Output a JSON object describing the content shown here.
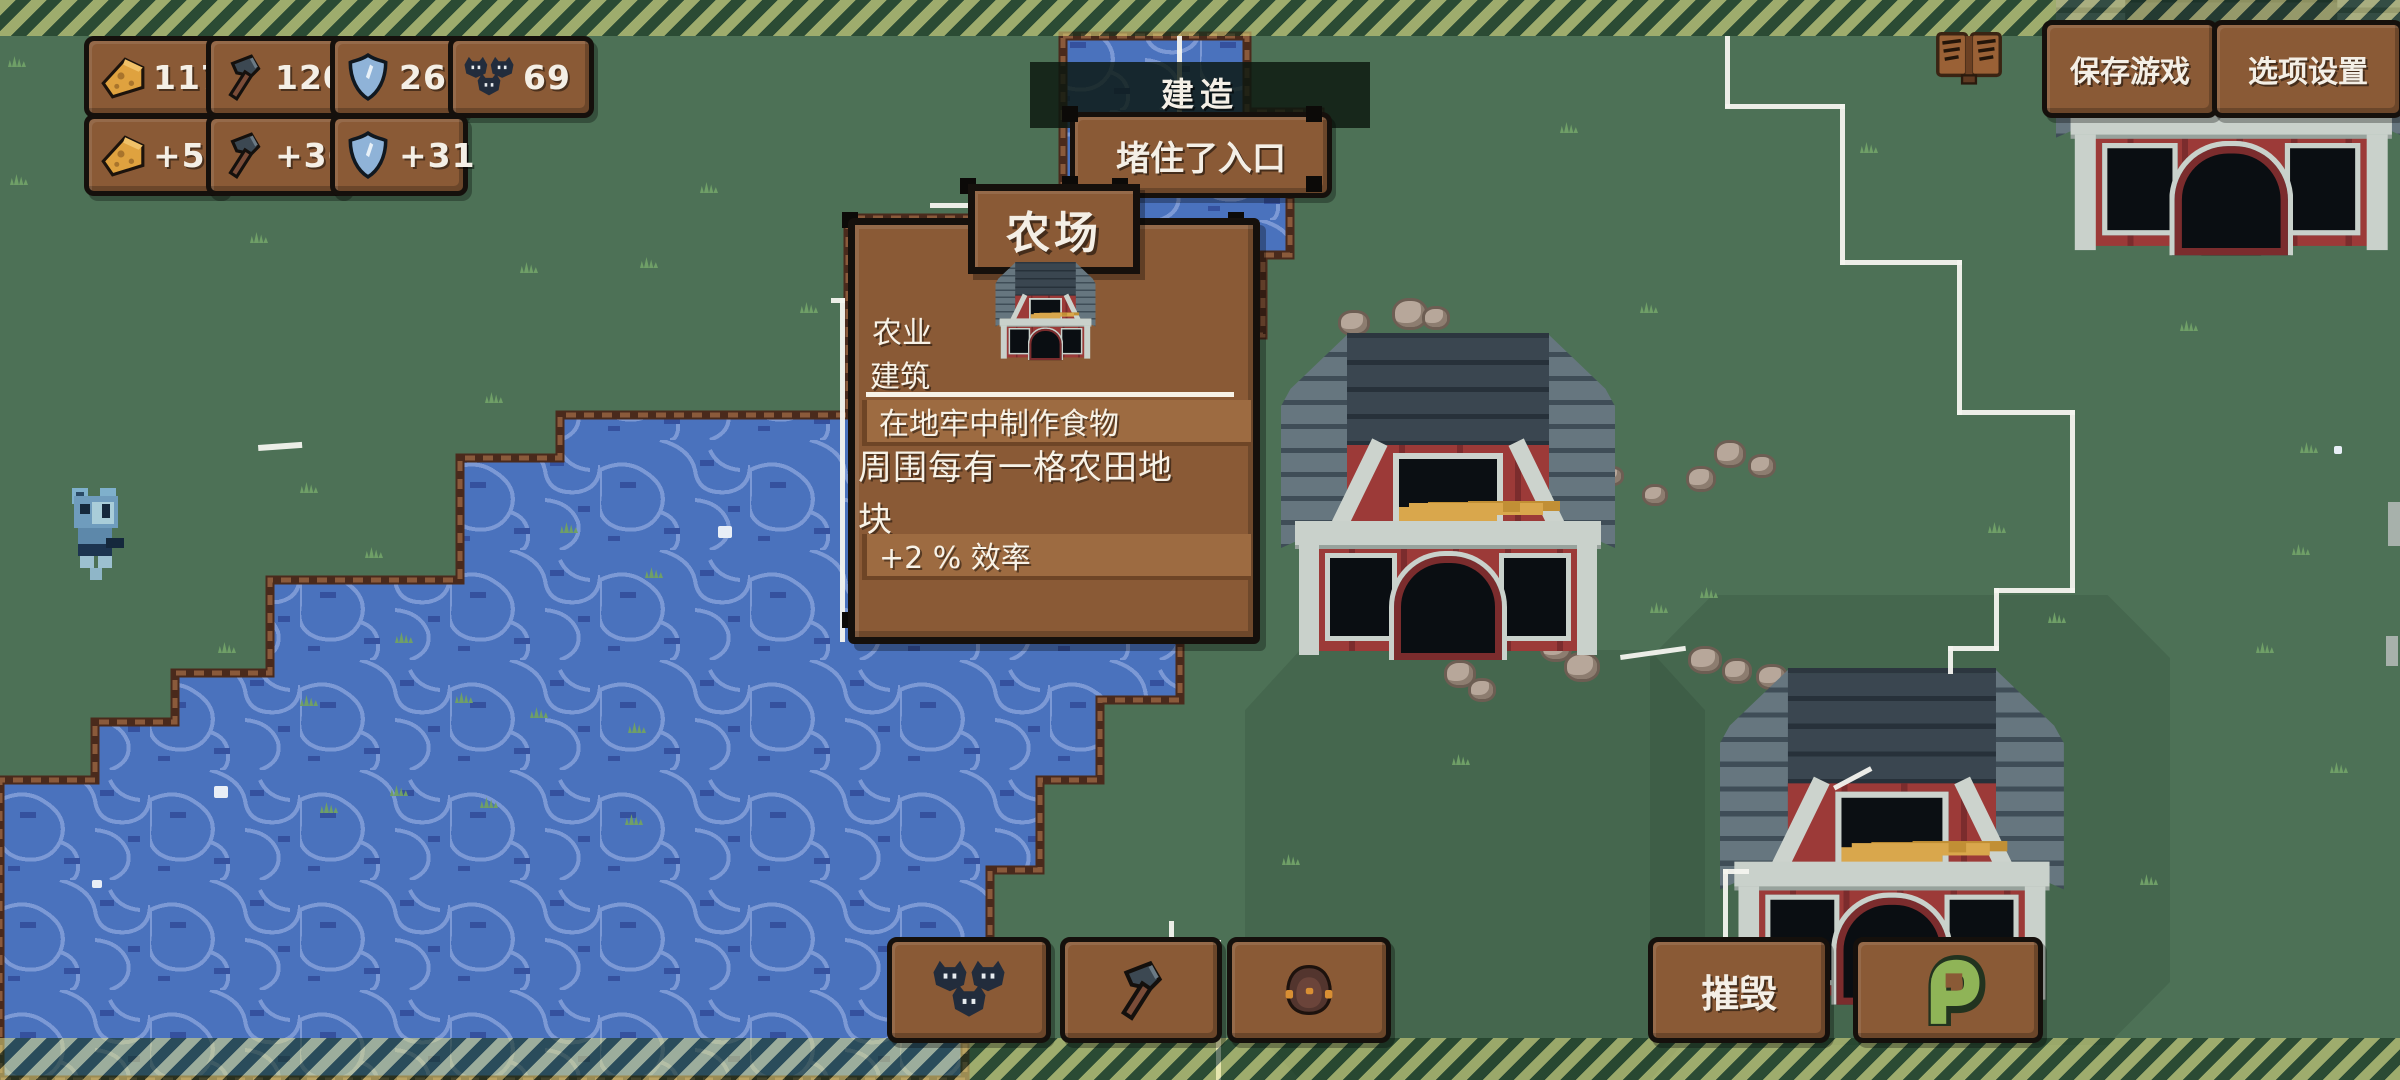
{
  "hud": {
    "resources": [
      {
        "icon": "cheese-icon",
        "value": "1175"
      },
      {
        "icon": "hammer-icon",
        "value": "120"
      },
      {
        "icon": "shield-icon",
        "value": "268"
      },
      {
        "icon": "bats-icon",
        "value": "69"
      }
    ],
    "income": [
      {
        "icon": "cheese-icon",
        "value": "+59"
      },
      {
        "icon": "hammer-icon",
        "value": "+36"
      },
      {
        "icon": "shield-icon",
        "value": "+31"
      }
    ]
  },
  "top_right": {
    "encyclopedia_icon": "book-icon",
    "save_label": "保存游戏",
    "options_label": "选项设置"
  },
  "build_overlay": {
    "title": "建造",
    "subtitle": "堵住了入口"
  },
  "tooltip": {
    "title": "农场",
    "category_line1": "农业",
    "category_line2": "建筑",
    "craft_row": "在地牢中制作食物",
    "desc_line1": "周围每有一格农田地",
    "desc_line2": "块",
    "effect": "+2 % 效率"
  },
  "bottom_bar": {
    "buttons": [
      {
        "icon": "bats-icon"
      },
      {
        "icon": "hammer-icon"
      },
      {
        "icon": "mole-icon"
      }
    ],
    "demolish_label": "摧毁",
    "snake_icon": "snake-icon"
  },
  "colors": {
    "grass": "#4d7156",
    "water": "#4a72bd",
    "water_line": "#7c99d5",
    "dirt": "#4a2a1c",
    "panel_brown": "#8a5a36",
    "panel_strip": "#9d6b41",
    "barn_red": "#9c3a38",
    "roof_slate": "#3a4650",
    "border_white": "#f4f4ef",
    "text": "#f4efe6"
  }
}
